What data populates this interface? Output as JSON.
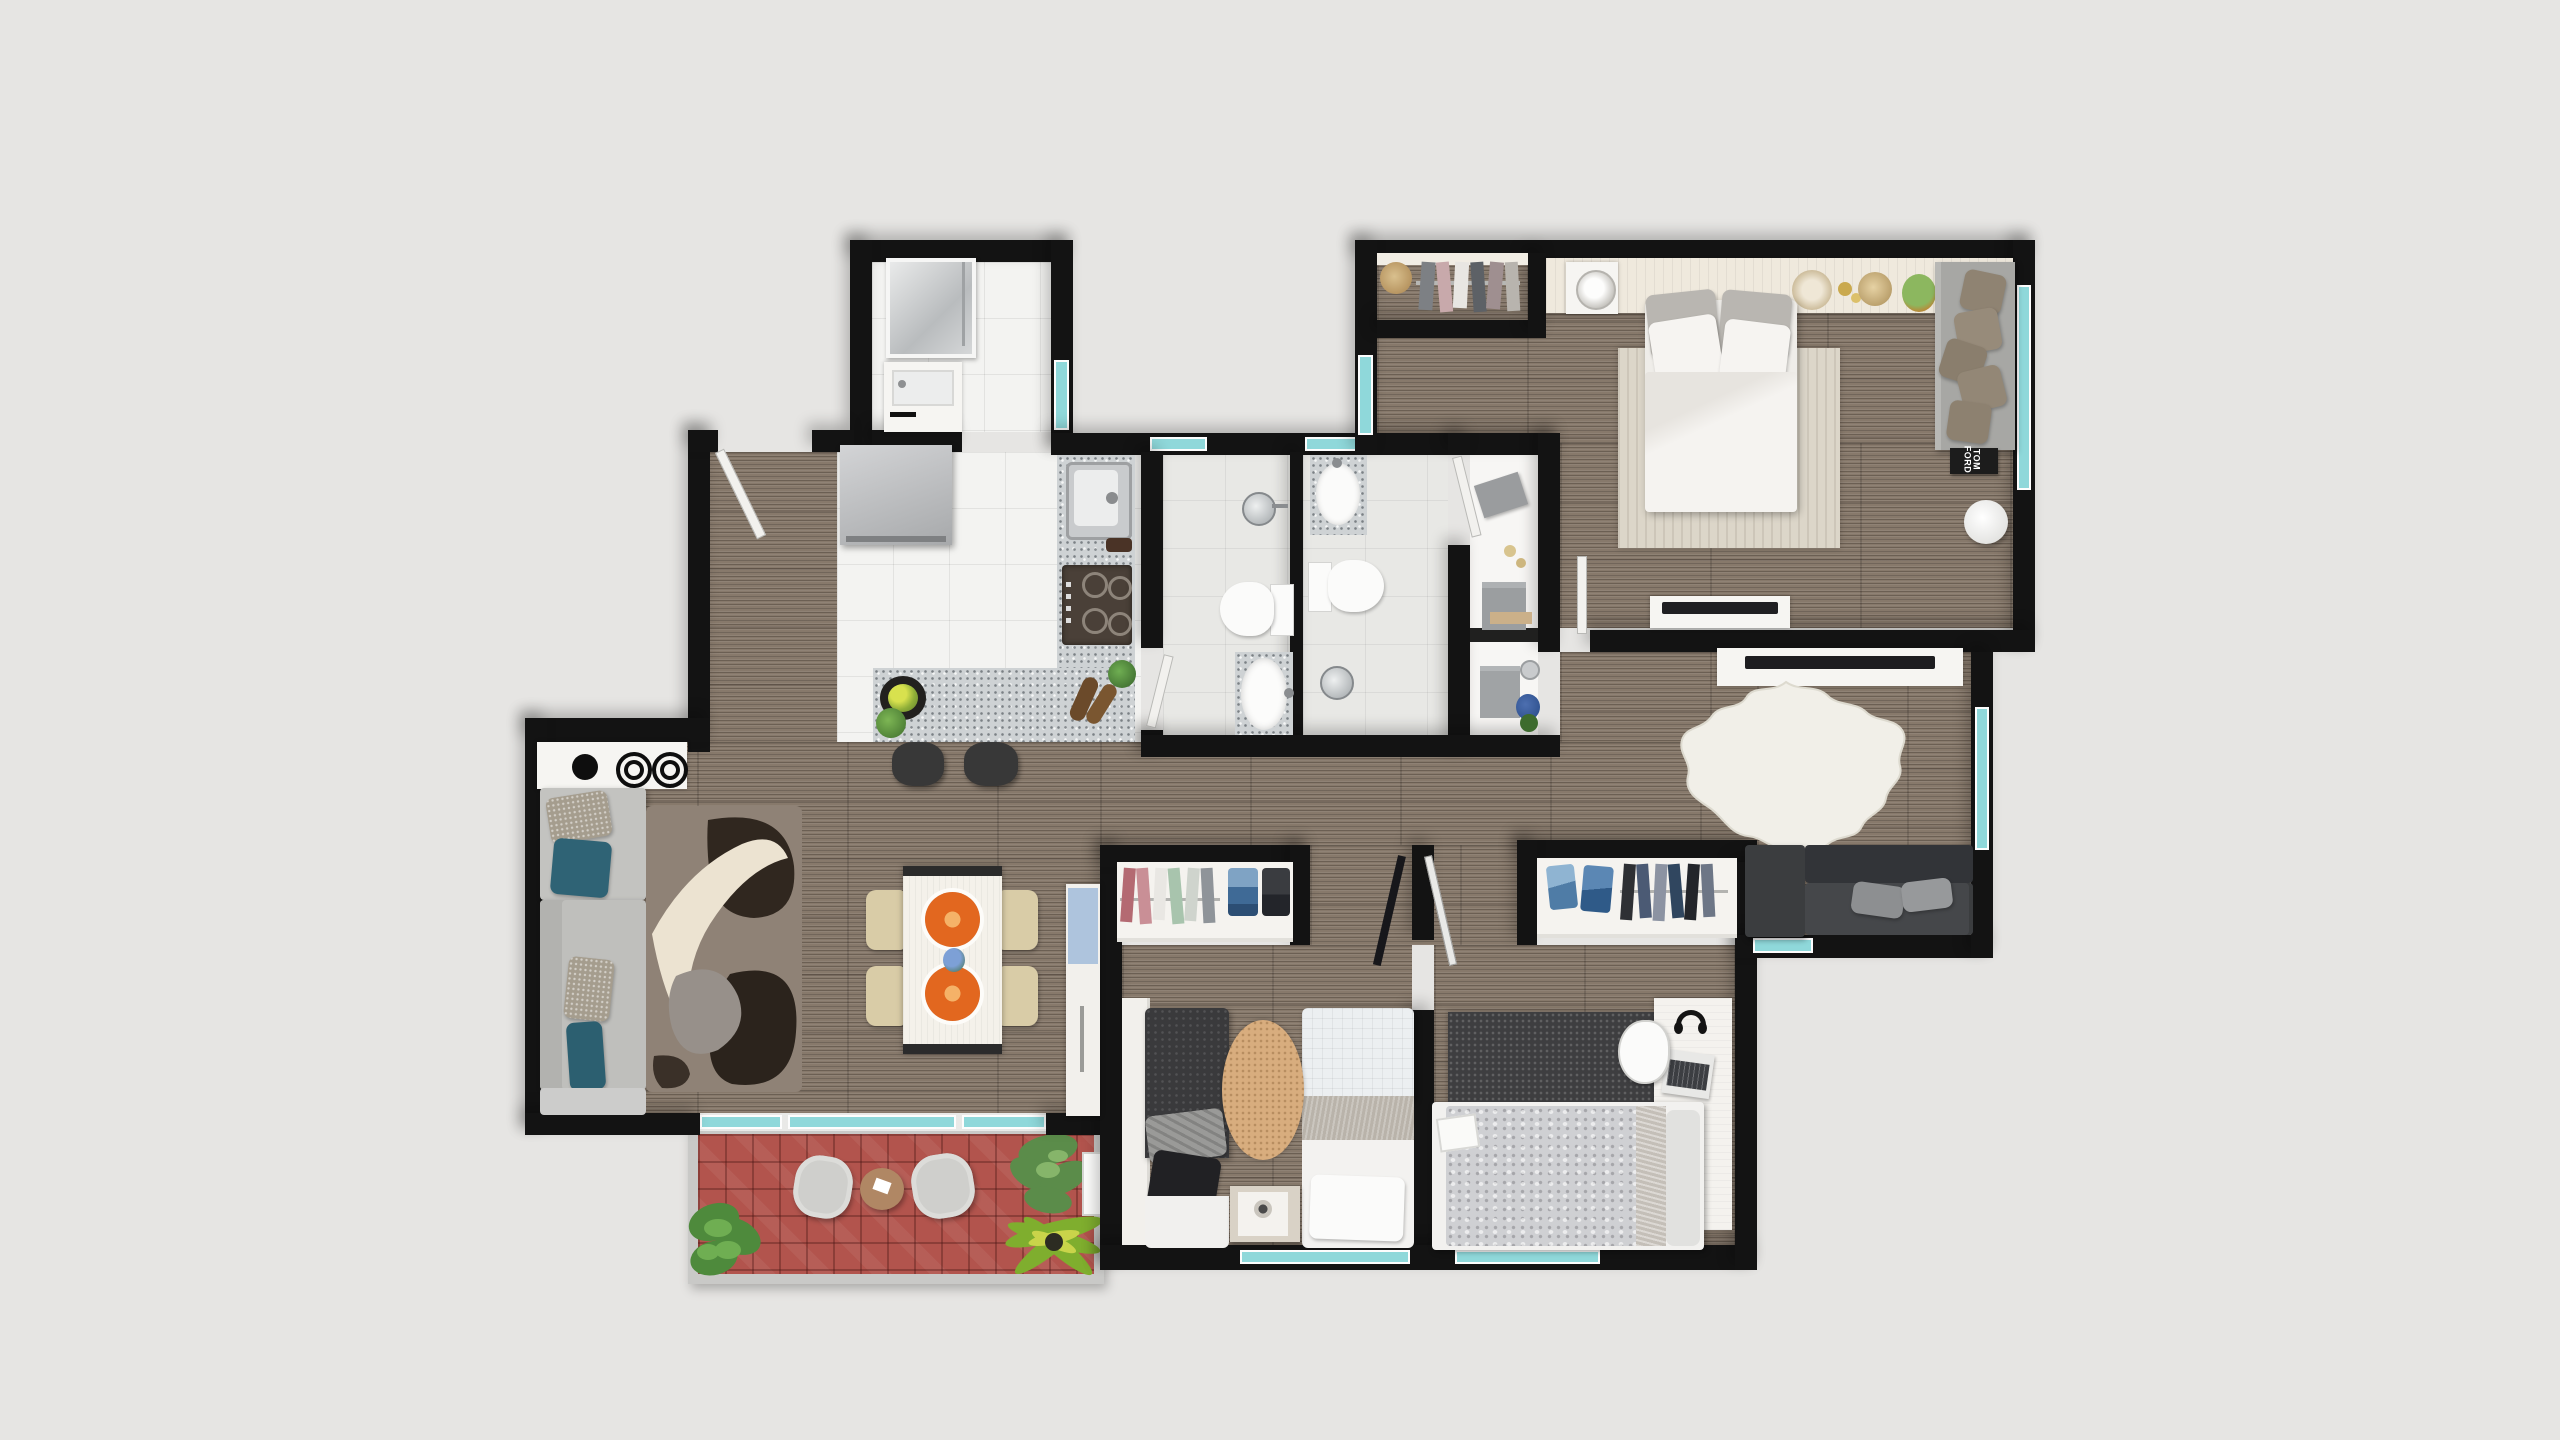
{
  "title": "apartment-floor-plan-top-view",
  "labels": {
    "book_title": "TOM FORD"
  },
  "palette": {
    "bg": "#e6e5e3",
    "wall": "#131313",
    "wood": "#87796b",
    "tile": "#f3f3f1",
    "bathtile": "#e8e8e5",
    "granite": "#ced2d4",
    "teal": "#8fd8da",
    "red": "#b2544d",
    "rail": "#c9c9c7",
    "furn": "#f6f5f2",
    "sofa-light": "#c3c3c0",
    "sofa-dark": "#3a3c3e",
    "teal-pillow": "#2f6375",
    "orange": "#e2671f",
    "chair": "#d9cca7",
    "rug-light": "#dcd6c9",
    "cowhide": "#f2f0e9",
    "kid-rug": "#d8ad7e",
    "dark-rug": "#3e3e40",
    "silver": "#cfd0d3",
    "cream": "#efe9dd"
  },
  "rooms": [
    {
      "name": "entry-hall",
      "floor": "wood"
    },
    {
      "name": "laundry-bathroom",
      "floor": "white-tile",
      "fixtures": [
        "shower",
        "vanity-sink",
        "window"
      ]
    },
    {
      "name": "kitchen",
      "floor": "white-tile",
      "fixtures": [
        "fridge",
        "stainless-sink",
        "gas-cooktop",
        "granite-counter",
        "granite-peninsula",
        "fruit-bowl",
        "plants",
        "wine-bottles",
        "two-stools"
      ]
    },
    {
      "name": "bathroom-1",
      "floor": "gray-tile",
      "fixtures": [
        "round-sink",
        "toilet",
        "bathtub-on-granite",
        "window"
      ]
    },
    {
      "name": "bathroom-2",
      "floor": "gray-tile",
      "fixtures": [
        "counter-sink",
        "toilet",
        "round-sink",
        "door",
        "window"
      ]
    },
    {
      "name": "utility-closet",
      "floor": "white",
      "fixtures": [
        "towels",
        "candles",
        "storage-boxes",
        "plant-jar"
      ]
    },
    {
      "name": "master-bedroom",
      "floor": "wood",
      "fixtures": [
        "wardrobe-clothes-rail",
        "headboard-shelf",
        "nightstand-lamp",
        "double-bed",
        "area-rug",
        "chaise-sofa-pillows",
        "book-table",
        "round-side-table",
        "tv-console",
        "hat",
        "candles",
        "basket",
        "plant",
        "windows"
      ]
    },
    {
      "name": "living-room",
      "floor": "wood",
      "fixtures": [
        "counter-with-burners",
        "l-sofa-light",
        "patterned-shag-rug",
        "tv-console",
        "cowhide-rug",
        "dark-sofa",
        "windows"
      ]
    },
    {
      "name": "dining-area",
      "floor": "wood",
      "fixtures": [
        "table",
        "four-chairs",
        "two-orange-platters",
        "flower-vase",
        "tall-cabinet"
      ]
    },
    {
      "name": "hallway",
      "floor": "wood",
      "fixtures": [
        "easel-rack"
      ]
    },
    {
      "name": "bedroom-2",
      "floor": "wood",
      "fixtures": [
        "closet-clothes",
        "wardrobe",
        "two-twin-beds",
        "oval-rug",
        "nightstand-lamp",
        "window"
      ]
    },
    {
      "name": "bedroom-3",
      "floor": "wood",
      "fixtures": [
        "closet-jeans-clothes",
        "dark-rug",
        "desk-laptop-headphones",
        "chair",
        "bed-silver-duvet",
        "window"
      ]
    },
    {
      "name": "balcony",
      "floor": "red-tile",
      "fixtures": [
        "two-chairs",
        "round-table",
        "plants",
        "planter-box",
        "railing",
        "windows"
      ]
    }
  ]
}
